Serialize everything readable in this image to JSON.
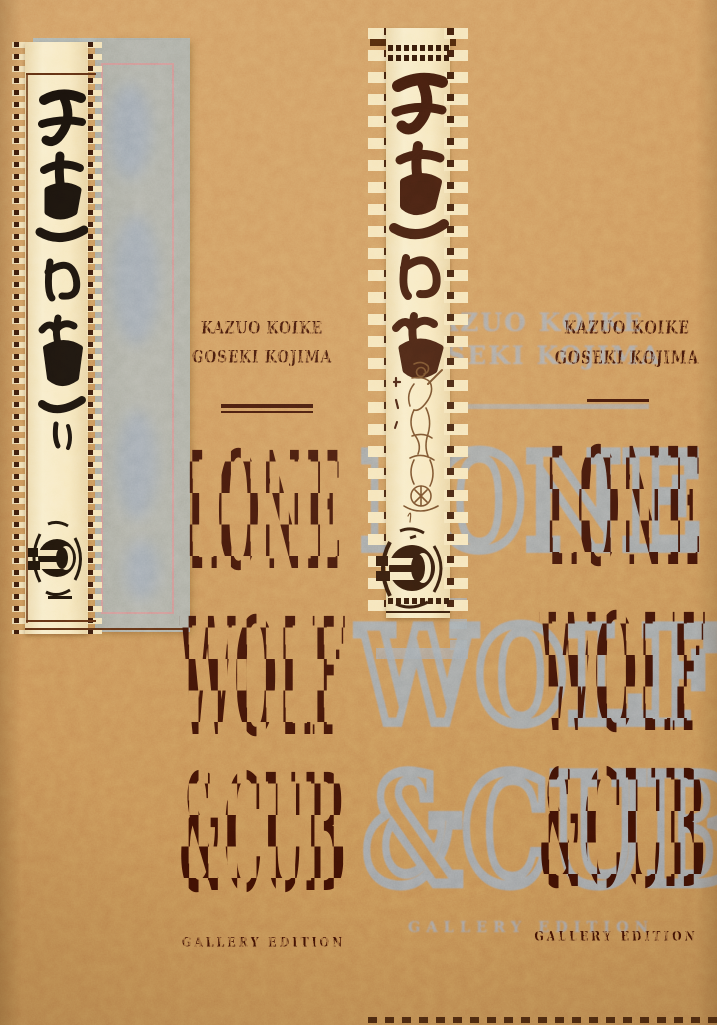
{
  "description": "Photograph of the Lone Wolf & Cub manga hardcover: tan burlap cover, kanji scroll strips, stamped dark title with gray echo print",
  "title": {
    "line1": "LONE",
    "line2": "WOLF",
    "line3": "&CUB",
    "full": "Lone Wolf & Cub"
  },
  "authors": {
    "line1": "KAZUO KOIKE",
    "line2": "GOSEKI KOJIMA"
  },
  "edition": {
    "label": "GALLERY EDITION"
  },
  "calligraphy": {
    "kanji": "子連れ狼",
    "romaji": "Kozure Okami",
    "meaning": "Lone Wolf and Cub"
  },
  "icons": {
    "kanji_calligraphy": "vertical brush calligraphy on scroll",
    "samurai_illustration": "ink sketch of samurai with baby cart",
    "circle_crest": "brush-drawn circle crest with horizontal bars",
    "scroll_stitches": "stitched tab edges of hanging scroll"
  },
  "colors": {
    "background_tan": "#c8945c",
    "ink_dark": "#3a0f03",
    "ghost_gray": "#96a2ac",
    "scroll_cream": "#f5e6bd",
    "panel_gray": "#a7a9a1",
    "accent_pink": "#d18c8c"
  }
}
